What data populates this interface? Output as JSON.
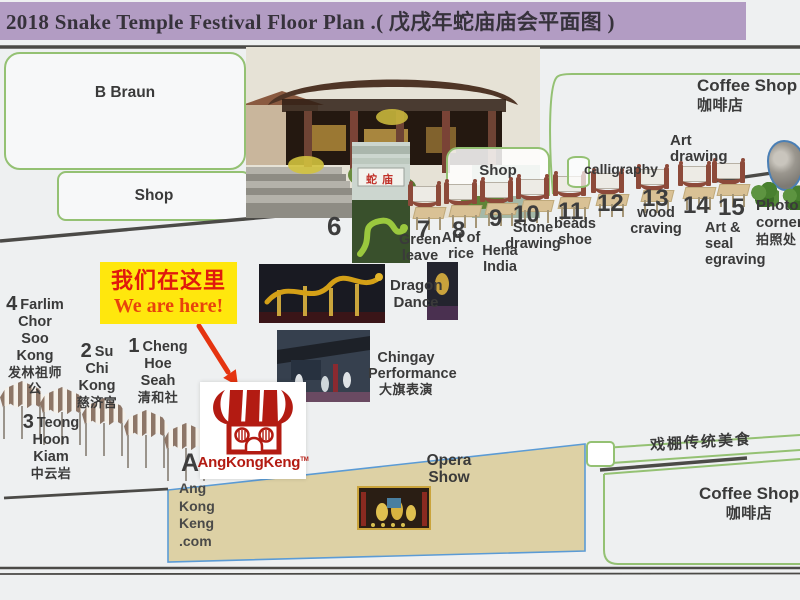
{
  "title": "2018 Snake Temple Festival Floor Plan .( 戊戌年蛇庙庙会平面图 )",
  "boxes": {
    "b_braun": "B Braun",
    "shop_left": "Shop",
    "shop_mid": "Shop",
    "coffee_top_en": "Coffee Shop",
    "coffee_top_zh": "咖啡店",
    "coffee_bottom_en": "Coffee Shop",
    "coffee_bottom_zh": "咖啡店",
    "food_strip": "戏棚传统美食"
  },
  "callout": {
    "zh": "我们在这里",
    "en": "We are here!"
  },
  "temple_sign": "蛇庙",
  "stall_numbers": {
    "s6": "6",
    "s7": "7",
    "s8": "8",
    "s9": "9",
    "s10": "10",
    "s11": "11",
    "s12": "12",
    "s13": "13",
    "s14": "14",
    "s15": "15"
  },
  "stall_labels": {
    "s7": [
      "Green",
      "leave"
    ],
    "s8": [
      "Art of",
      "rice"
    ],
    "s9": [
      "Hena",
      "India"
    ],
    "s10": [
      "Stone",
      "drawing"
    ],
    "s11": [
      "beads",
      "shoe"
    ],
    "s13": [
      "wood",
      "craving"
    ],
    "s15": [
      "Art &",
      "seal",
      "egraving"
    ],
    "calligraphy": "calligraphy",
    "art_drawing": [
      "Art",
      "drawing"
    ],
    "photo_corner": [
      "Photo",
      "corner",
      "拍照处"
    ]
  },
  "temple_stalls": {
    "t4": {
      "num": "4",
      "lines": [
        "Farlim",
        "Chor Soo",
        "Kong",
        "发林祖师",
        "公"
      ]
    },
    "t2": {
      "num": "2",
      "lines": [
        "Su Chi",
        "Kong",
        "慈济宫"
      ]
    },
    "t1": {
      "num": "1",
      "lines": [
        "Cheng",
        "Hoe Seah",
        "清和社"
      ]
    },
    "t3": {
      "num": "3",
      "lines": [
        "Teong",
        "Hoon",
        "Kiam",
        "中云岩"
      ]
    },
    "marker_a": "A",
    "website_lines": [
      "Ang",
      "Kong",
      "Keng",
      ".com"
    ]
  },
  "performances": {
    "dragon": [
      "Dragon",
      "Dance"
    ],
    "chingay": [
      "Chingay",
      "Performance",
      "大旗表演"
    ],
    "opera": [
      "Opera",
      "Show"
    ]
  },
  "logo": {
    "text": "AngKongKeng",
    "tm": "TM"
  },
  "colors": {
    "title_bg": "#b29cc3",
    "paper": "#eef0f1",
    "green_border": "#94c173",
    "road": "#4b4a47",
    "opera_fill": "#ddd1a5",
    "opera_border": "#5b9bd5",
    "logo_red": "#b31b12",
    "callout_bg": "#ffe70d",
    "callout_text_zh": "#e0190d",
    "callout_text_en": "#e8430c",
    "arrow_red": "#e53410",
    "barrier_red": "#8d4a3a",
    "table_tan": "#d9c195",
    "tent_stripe": "#8d7667"
  }
}
